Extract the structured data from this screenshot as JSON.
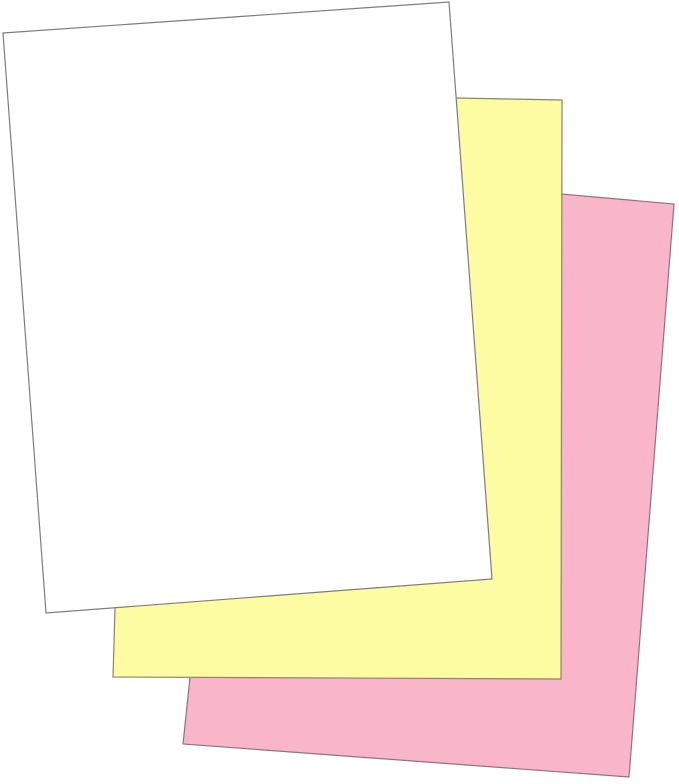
{
  "image": {
    "background_color": "#ffffff",
    "sheets": {
      "pink": {
        "id": "pink-sheet",
        "stacking": "back",
        "fill": "#f9b6cb",
        "stroke": "#93707e"
      },
      "yellow": {
        "id": "yellow-sheet",
        "stacking": "middle",
        "fill": "#fdfca2",
        "stroke": "#8d8565"
      },
      "white": {
        "id": "white-sheet",
        "stacking": "front",
        "fill": "#ffffff",
        "stroke": "#7d7d7d"
      }
    }
  }
}
